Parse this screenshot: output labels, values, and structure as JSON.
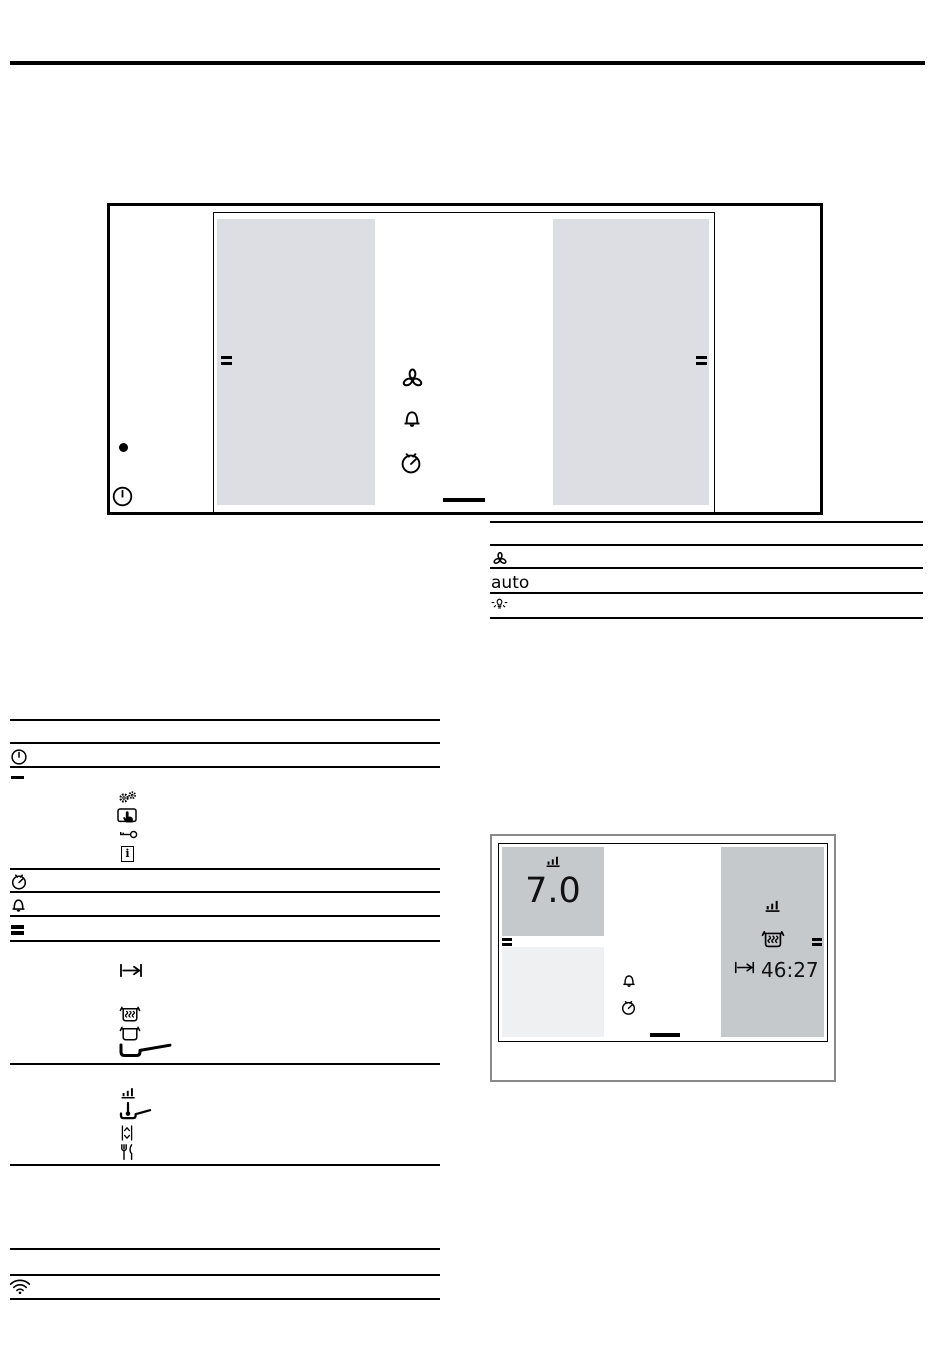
{
  "colors": {
    "panel_gray": "#dcdee3",
    "panel_dark_gray": "#c6c9cc",
    "panel_faint_gray": "#eef0f2",
    "box2_border_gray": "#8a8a8a",
    "ink": "#000000"
  },
  "control_panel_overview": {
    "left_column_icons": [
      "standby-dot",
      "power-icon"
    ],
    "display": {
      "left_zone_panel_marker": "equals-handle",
      "right_zone_panel_marker": "equals-handle",
      "center_icons": [
        "fan-icon",
        "alarm-bell-icon",
        "timer-icon"
      ],
      "home_indicator": "dash"
    }
  },
  "symbols_table": {
    "rows": [
      {
        "symbol": ""
      },
      {
        "symbol": "fan-icon"
      },
      {
        "symbol_text": "auto"
      },
      {
        "symbol": "light-icon"
      }
    ],
    "auto_label": "auto"
  },
  "left_table": {
    "row_icons": [
      "power-icon",
      "dash-icon",
      "gears-icon",
      "touch-demo-icon",
      "key-icon",
      "info-icon",
      "timer-icon",
      "alarm-bell-icon",
      "equals-icon",
      "goto-end-icon",
      "keep-warm-pot-icon",
      "pot-icon",
      "pan-icon",
      "power-level-bars-icon",
      "frying-sensor-icon",
      "up-down-icon",
      "gourmet-icon",
      "wifi-icon"
    ],
    "info_glyph": "i"
  },
  "display_example": {
    "power_level": "7.0",
    "timer_value": "46:27",
    "left_zone_icons": [
      "power-level-bars-icon"
    ],
    "right_zone_icons": [
      "power-level-bars-icon",
      "keep-warm-pot-icon",
      "goto-end-icon"
    ],
    "center_icons": [
      "alarm-bell-icon",
      "timer-icon"
    ],
    "home_indicator": "dash"
  }
}
